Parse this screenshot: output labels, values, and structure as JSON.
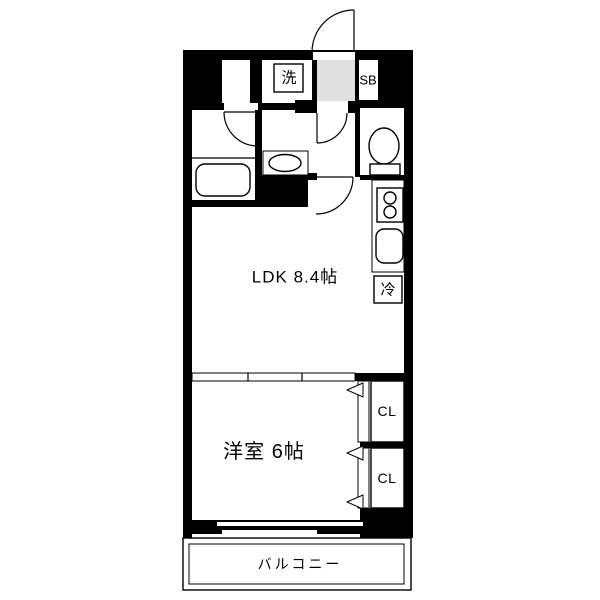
{
  "floor_plan": {
    "labels": {
      "ldk": "LDK 8.4帖",
      "western_room": "洋室 6帖",
      "balcony": "バルコニー",
      "washing_machine": "洗",
      "shoe_box": "SB",
      "refrigerator": "冷",
      "closet_upper": "CL",
      "closet_lower": "CL"
    },
    "colors": {
      "wall": "#000000",
      "entry_floor": "#e0e0e0",
      "background": "#ffffff",
      "line": "#000000"
    }
  }
}
